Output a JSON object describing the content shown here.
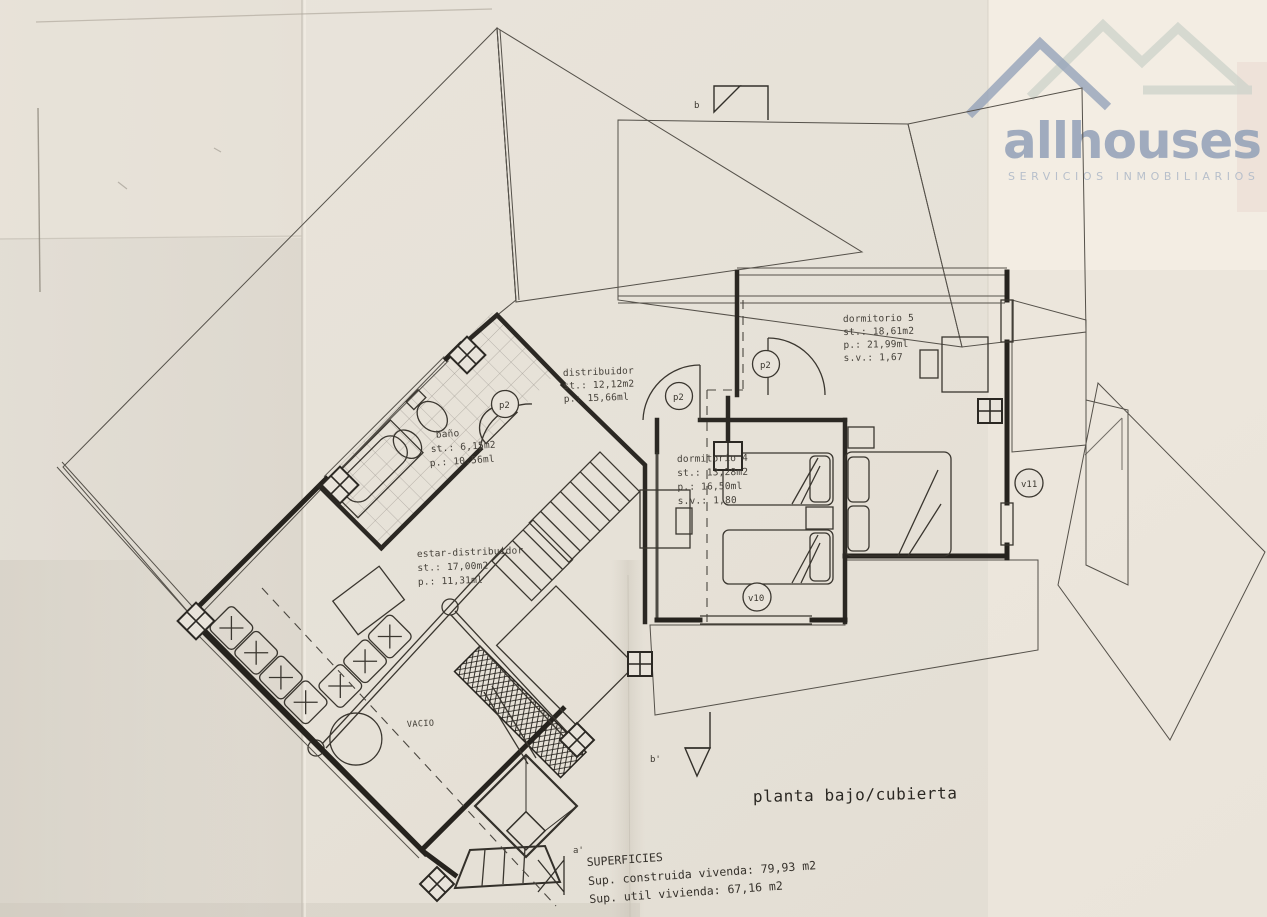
{
  "branding": {
    "logo_text": "allhouses",
    "tagline": "SERVICIOS INMOBILIARIOS",
    "icon": "house-roofs-icon",
    "brand_color": "#95a3b9",
    "brand_light_color": "#ccd2ca",
    "tagline_color": "#b4bdca"
  },
  "plan": {
    "title": "planta bajo/cubierta",
    "rooms": [
      {
        "id": "dormitorio5",
        "name": "dormitorio 5",
        "st": "st.: 18,61m2",
        "p": "p.: 21,99ml",
        "sv": "s.v.: 1,67"
      },
      {
        "id": "distribuidor",
        "name": "distribuidor",
        "st": "st.: 12,12m2",
        "p": "p.: 15,66ml"
      },
      {
        "id": "bano",
        "name": "baño",
        "st": "st.: 6,15m2",
        "p": "p.: 10,56ml"
      },
      {
        "id": "dormitorio4",
        "name": "dormitorio 4",
        "st": "st.: 13,28m2",
        "p": "p.: 16,50ml",
        "sv": "s.v.: 1,80"
      },
      {
        "id": "estar",
        "name": "estar-distribuidor",
        "st": "st.: 17,00m2",
        "p": "p.: 11,31ml"
      },
      {
        "id": "vacio",
        "name": "VACIO"
      }
    ],
    "markers": {
      "door": "p2",
      "window10": "v10",
      "window11": "v11",
      "section_top": "b",
      "section_bottom": "b'",
      "section_a": "a'"
    },
    "superficies": {
      "heading": "SUPERFICIES",
      "construida": "Sup. construida vivenda: 79,93 m2",
      "util": "Sup. util vivienda: 67,16 m2"
    }
  },
  "colors": {
    "paper": "#e8e3da",
    "ink": "#3a362f",
    "hatch": "#5a564e"
  }
}
